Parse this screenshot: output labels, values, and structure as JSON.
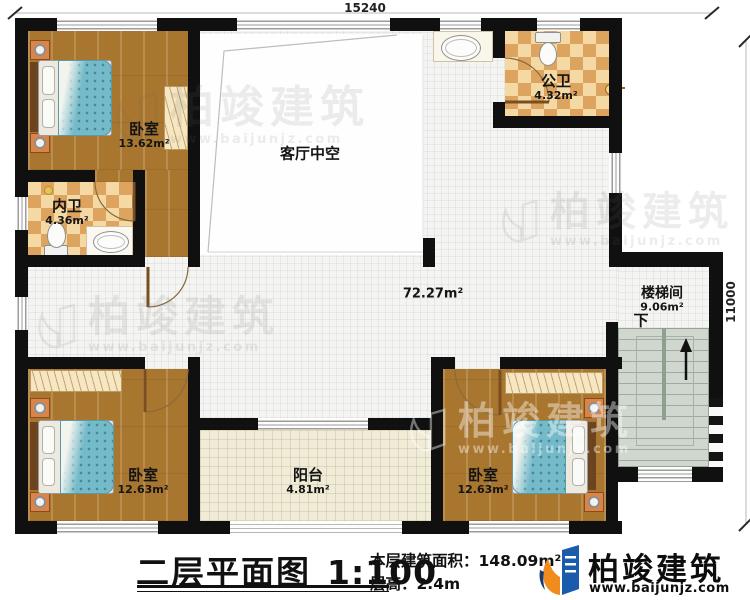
{
  "dimensions": {
    "width": "15240",
    "height": "11000"
  },
  "rooms": {
    "bedroom1": {
      "name": "卧室",
      "area": "13.62m²"
    },
    "inner_bath": {
      "name": "内卫",
      "area": "4.36m²"
    },
    "public_bath": {
      "name": "公卫",
      "area": "4.32m²"
    },
    "living_void": {
      "name": "客厅中空"
    },
    "hallway": {
      "area": "72.27m²"
    },
    "stairwell": {
      "name": "楼梯间",
      "area": "9.06m²",
      "down_label": "下"
    },
    "bedroom2": {
      "name": "卧室",
      "area": "12.63m²"
    },
    "bedroom3": {
      "name": "卧室",
      "area": "12.63m²"
    },
    "balcony": {
      "name": "阳台",
      "area": "4.81m²"
    }
  },
  "title_block": {
    "title": "二层平面图",
    "scale": "1:100",
    "floor_area_label": "本层建筑面积：",
    "floor_area_value": "148.09m²",
    "floor_height_label": "层高：",
    "floor_height_value": "2.4m"
  },
  "brand": {
    "name": "柏竣建筑",
    "website": "www.baijunjz.com"
  },
  "watermark": {
    "name": "柏竣建筑",
    "website": "www.baijunjz.com"
  }
}
